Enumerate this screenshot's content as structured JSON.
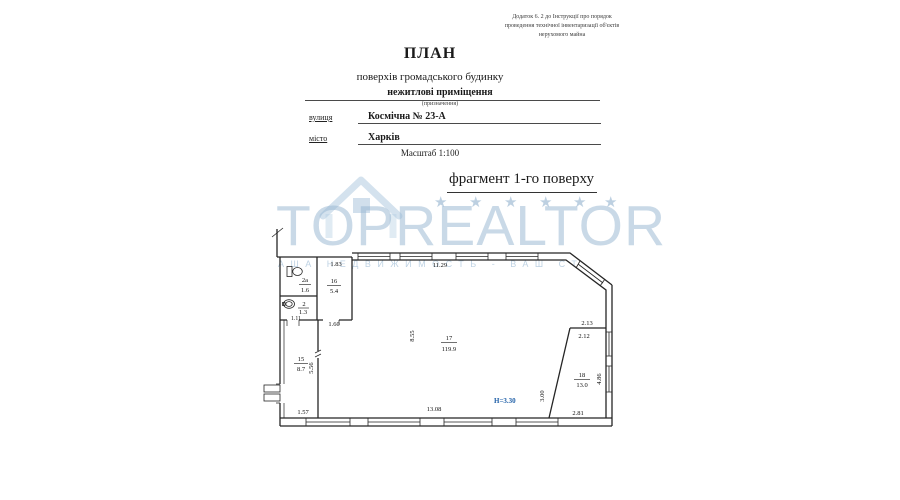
{
  "document": {
    "appendix_note": [
      "Додаток 6. 2 до Інструкції про порядок",
      "проведення технічної інвентаризації об'єктів",
      "нерухомого майна"
    ],
    "title": "ПЛАН",
    "subtitle": "поверхів громадського будинку",
    "purpose": "нежитлові приміщення",
    "purpose_caption": "(призначення)",
    "street_label": "вулиця",
    "street_value": "Космічна № 23-А",
    "city_label": "місто",
    "city_value": "Харків",
    "scale_note": "Масштаб 1:100",
    "fragment_title": "фрагмент 1-го поверху"
  },
  "watermark": {
    "brand": "TOPREALTOR",
    "tagline": "АША НЕДВИЖИМОСТЬ - ВАШ СТ",
    "star": "★",
    "color": "#93b4d0"
  },
  "plan": {
    "height_note": "Н=3.30",
    "height_note_color": "#2060a8",
    "rooms": [
      {
        "number": "2а",
        "area": "1.6"
      },
      {
        "number": "2",
        "area": "1.3"
      },
      {
        "number": "16",
        "area": "5.4"
      },
      {
        "number": "15",
        "area": "8.7"
      },
      {
        "number": "17",
        "area": "119.9"
      },
      {
        "number": "18",
        "area": "13.0"
      }
    ],
    "dims": {
      "top_left": "1.83",
      "top_main": "11.29",
      "below_16": "1.60",
      "below_2": "1.11",
      "vert_17": "8.55",
      "vert_15": "5.56",
      "bottom_left": "1.57",
      "bottom_main": "13.08",
      "vert_18_left": "3.00",
      "top_18_a": "2.13",
      "top_18_b": "2.12",
      "vert_right": "4.86",
      "bottom_right": "2.81"
    }
  }
}
